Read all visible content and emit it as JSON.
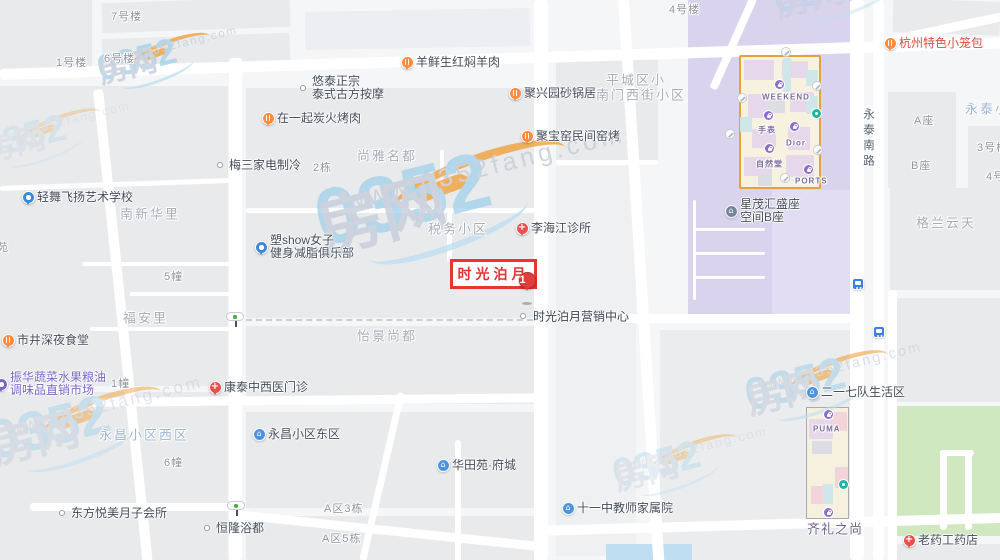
{
  "palette": {
    "accent_red": "#e23d3c",
    "restaurant_orange": "#ff8b3d",
    "medical_red": "#e8504d",
    "community_blue": "#4f94da",
    "education_blue": "#3d88dd",
    "market_purple": "#7a66c2",
    "building_slate": "#7286a0",
    "mall_purple": "#8a6fd0",
    "district_purple": "#d9d3ee",
    "park_green": "#cfe8c0",
    "water_blue": "#bfdef2"
  },
  "highlight": {
    "box": {
      "label": "时光泊月",
      "x": 450,
      "y": 259,
      "w": 87,
      "h": 30
    },
    "marker": {
      "number": "1",
      "x": 527,
      "y": 280
    },
    "caption": {
      "text": "时光泊月营销中心",
      "x": 533,
      "y": 316,
      "dot_x": 523,
      "dot_y": 316
    }
  },
  "road_label": {
    "text": "永泰南路",
    "x": 860,
    "y": 108
  },
  "watermark": {
    "brand_blue": "0352",
    "brand_gray": "房网",
    "url": "www.0352fang.com",
    "instances": [
      [
        95,
        58,
        0.95,
        0.8
      ],
      [
        310,
        196,
        2.1,
        0.8
      ],
      [
        -15,
        425,
        1.45,
        0.5
      ],
      [
        770,
        -14,
        1.15,
        0.45
      ],
      [
        742,
        382,
        1.2,
        0.6
      ],
      [
        610,
        462,
        1.05,
        0.38
      ],
      [
        -20,
        135,
        1.0,
        0.3
      ]
    ]
  },
  "pois": [
    {
      "x": 407,
      "y": 62,
      "icon": "restaurant-pin",
      "lines": [
        "羊鲜生红焖羊肉"
      ]
    },
    {
      "x": 515,
      "y": 93,
      "icon": "restaurant-pin",
      "lines": [
        "聚兴园砂锅居"
      ]
    },
    {
      "x": 527,
      "y": 136,
      "icon": "restaurant-pin",
      "lines": [
        "聚宝窑民间窑烤"
      ]
    },
    {
      "x": 268,
      "y": 118,
      "icon": "restaurant-pin",
      "lines": [
        "在一起炭火烤肉"
      ]
    },
    {
      "x": 890,
      "y": 43,
      "icon": "restaurant-pin",
      "lines": [
        "杭州特色小笼包"
      ],
      "tc": "#e04b43"
    },
    {
      "x": 8,
      "y": 340,
      "icon": "restaurant-pin",
      "lines": [
        "市井深夜食堂"
      ]
    },
    {
      "x": 303,
      "y": 88,
      "icon": "dot",
      "lines": [
        "悠泰正宗",
        "泰式古方按摩"
      ]
    },
    {
      "x": 220,
      "y": 165,
      "icon": "dot",
      "lines": [
        "梅三家电制冷"
      ]
    },
    {
      "x": 62,
      "y": 513,
      "icon": "dot",
      "lines": [
        "东方悦美月子会所"
      ]
    },
    {
      "x": 207,
      "y": 528,
      "icon": "dot",
      "lines": [
        "恒隆浴都"
      ]
    },
    {
      "x": 522,
      "y": 228,
      "icon": "medical-pin",
      "lines": [
        "李海江诊所"
      ]
    },
    {
      "x": 215,
      "y": 387,
      "icon": "medical-pin",
      "lines": [
        "康泰中西医门诊"
      ]
    },
    {
      "x": 909,
      "y": 540,
      "icon": "medical-pin",
      "lines": [
        "老药工药店"
      ]
    },
    {
      "x": 28,
      "y": 197,
      "icon": "education-pin",
      "lines": [
        "轻舞飞扬艺术学校"
      ]
    },
    {
      "x": 261,
      "y": 247,
      "icon": "education-pin",
      "lines": [
        "塑show女子",
        "健身减脂俱乐部"
      ]
    },
    {
      "x": 1,
      "y": 384,
      "icon": "market-pin",
      "lines": [
        "振华蔬菜水果粮油",
        "调味品直销市场"
      ],
      "tc": "#7a66c2"
    },
    {
      "x": 259,
      "y": 434,
      "icon": "community-icon",
      "lines": [
        "永昌小区东区"
      ]
    },
    {
      "x": 443,
      "y": 465,
      "icon": "community-icon",
      "lines": [
        "华田苑·府城"
      ]
    },
    {
      "x": 568,
      "y": 508,
      "icon": "community-icon",
      "lines": [
        "十一中教师家属院"
      ]
    },
    {
      "x": 812,
      "y": 392,
      "icon": "community-icon",
      "lines": [
        "二一七队生活区"
      ]
    },
    {
      "x": 731,
      "y": 211,
      "icon": "building-icon",
      "lines": [
        "星茂汇盛座",
        "空间B座"
      ]
    }
  ],
  "area_labels": [
    {
      "t": "尚雅名都",
      "x": 357,
      "y": 155
    },
    {
      "t": "税务小区",
      "x": 428,
      "y": 228
    },
    {
      "t": "平城区小",
      "x": 606,
      "y": 79
    },
    {
      "t": "南门西街小区",
      "x": 596,
      "y": 94
    },
    {
      "t": "南新华里",
      "x": 120,
      "y": 213
    },
    {
      "t": "福安里",
      "x": 123,
      "y": 317
    },
    {
      "t": "怡景尚都",
      "x": 357,
      "y": 335
    },
    {
      "t": "永昌小区西区",
      "x": 99,
      "y": 434,
      "c": "blue"
    },
    {
      "t": "格兰云天",
      "x": 916,
      "y": 222
    },
    {
      "t": "永泰小",
      "x": 965,
      "y": 108,
      "c": "blue"
    },
    {
      "t": "齐礼之尚",
      "x": 807,
      "y": 528,
      "c": "purple"
    }
  ],
  "building_labels": [
    {
      "t": "7号楼",
      "x": 111,
      "y": 16
    },
    {
      "t": "6号楼",
      "x": 104,
      "y": 58
    },
    {
      "t": "1号楼",
      "x": 56,
      "y": 62
    },
    {
      "t": "4号楼",
      "x": 669,
      "y": 9
    },
    {
      "t": "2栋",
      "x": 313,
      "y": 167
    },
    {
      "t": "5幢",
      "x": 164,
      "y": 276
    },
    {
      "t": "1幢",
      "x": 111,
      "y": 383
    },
    {
      "t": "6幢",
      "x": 164,
      "y": 462
    },
    {
      "t": "A区3栋",
      "x": 324,
      "y": 508
    },
    {
      "t": "A区5栋",
      "x": 322,
      "y": 538
    },
    {
      "t": "A座",
      "x": 914,
      "y": 120
    },
    {
      "t": "B座",
      "x": 911,
      "y": 165
    },
    {
      "t": "3号楼",
      "x": 977,
      "y": 147
    },
    {
      "t": "4号",
      "x": 986,
      "y": 176
    },
    {
      "t": "苑",
      "x": -3,
      "y": 247
    }
  ],
  "mall_weekend": {
    "outline": [
      739,
      55,
      82,
      134
    ],
    "rooms": [
      [
        744,
        60,
        30,
        20,
        "#e6d7ea"
      ],
      [
        782,
        61,
        26,
        17,
        "#e6d7ea"
      ],
      [
        748,
        94,
        20,
        24,
        "#e6d7ea"
      ],
      [
        790,
        92,
        24,
        20,
        "#e6d7ea"
      ],
      [
        752,
        129,
        24,
        19,
        "#e6d7ea"
      ],
      [
        788,
        127,
        22,
        23,
        "#e6d7ea"
      ],
      [
        744,
        157,
        28,
        19,
        "#e6d7ea"
      ],
      [
        786,
        155,
        28,
        22,
        "#e6d7ea"
      ],
      [
        783,
        58,
        8,
        34,
        "#cfe7e9"
      ],
      [
        806,
        96,
        12,
        18,
        "#cfe7e9"
      ],
      [
        740,
        117,
        12,
        15,
        "#cfe7e9"
      ],
      [
        806,
        70,
        12,
        16,
        "#cfe7e9"
      ],
      [
        768,
        100,
        17,
        13,
        "#dcdde2"
      ],
      [
        758,
        174,
        14,
        12,
        "#dcdde2"
      ]
    ],
    "stores": [
      {
        "t": "WEEKEND",
        "x": 762,
        "y": 97
      },
      {
        "t": "手表",
        "x": 758,
        "y": 130
      },
      {
        "t": "Dior",
        "x": 786,
        "y": 143
      },
      {
        "t": "自然堂",
        "x": 756,
        "y": 164
      },
      {
        "t": "PORTS",
        "x": 795,
        "y": 181
      }
    ],
    "bag_icons": [
      [
        779,
        84
      ],
      [
        768,
        115
      ],
      [
        794,
        126
      ],
      [
        769,
        148
      ],
      [
        808,
        169
      ]
    ],
    "facility_icons": [
      [
        786,
        52
      ],
      [
        817,
        86
      ],
      [
        742,
        98
      ],
      [
        730,
        134
      ],
      [
        785,
        178
      ],
      [
        818,
        150
      ]
    ],
    "green_icons": [
      [
        816,
        113
      ]
    ]
  },
  "mall_puma": {
    "outline": [
      806,
      407,
      43,
      112
    ],
    "rooms": [
      [
        809,
        419,
        24,
        20,
        "#e6d7ea"
      ],
      [
        812,
        441,
        20,
        13,
        "#dcdde2"
      ],
      [
        833,
        412,
        14,
        19,
        "#f3d4da"
      ],
      [
        835,
        467,
        13,
        21,
        "#f3d4da"
      ],
      [
        811,
        486,
        17,
        18,
        "#f3d4da"
      ],
      [
        823,
        484,
        10,
        20,
        "#cfe7e9"
      ]
    ],
    "stores": [
      {
        "t": "PUMA",
        "x": 813,
        "y": 429
      }
    ],
    "bag_icons": [
      [
        828,
        414
      ],
      [
        828,
        512
      ]
    ],
    "facility_icons": [],
    "green_icons": [
      [
        843,
        484
      ]
    ]
  },
  "transit": {
    "traffic_lights": [
      [
        235,
        316
      ],
      [
        236,
        505
      ]
    ],
    "bus_stops": [
      [
        858,
        284
      ],
      [
        879,
        332
      ]
    ]
  },
  "geometry": {
    "blocks": [
      [
        0,
        0,
        92,
        70,
        null,
        0,
        "city-block"
      ],
      [
        102,
        0,
        188,
        30,
        null,
        -2,
        "city-block"
      ],
      [
        102,
        36,
        188,
        34,
        null,
        -2,
        "city-block"
      ],
      [
        305,
        10,
        225,
        38,
        "#edeef1",
        -1,
        "city-block"
      ],
      [
        556,
        60,
        102,
        100,
        null,
        0,
        "city-block"
      ],
      [
        246,
        88,
        288,
        230,
        null,
        0,
        "city-block"
      ],
      [
        0,
        86,
        228,
        300,
        null,
        0,
        "city-block"
      ],
      [
        0,
        392,
        228,
        168,
        null,
        0,
        "city-block"
      ],
      [
        246,
        326,
        288,
        78,
        null,
        0,
        "city-block"
      ],
      [
        246,
        412,
        288,
        96,
        null,
        0,
        "city-block"
      ],
      [
        246,
        516,
        288,
        44,
        null,
        0,
        "city-block"
      ],
      [
        556,
        166,
        80,
        390,
        "#eff0f2",
        0,
        "city-block"
      ],
      [
        660,
        330,
        195,
        230,
        "#ebecee",
        0,
        "city-block"
      ],
      [
        688,
        0,
        168,
        318,
        "#d9d3ee",
        0,
        "mall-district-block"
      ],
      [
        772,
        190,
        80,
        125,
        "#e2ddf3",
        0,
        "mall-district-block"
      ],
      [
        893,
        0,
        107,
        34,
        null,
        2,
        "city-block"
      ],
      [
        888,
        92,
        68,
        96,
        null,
        0,
        "city-block"
      ],
      [
        968,
        126,
        32,
        68,
        null,
        0,
        "city-block"
      ],
      [
        890,
        188,
        110,
        102,
        null,
        0,
        "city-block"
      ],
      [
        890,
        298,
        110,
        104,
        null,
        0,
        "city-block"
      ],
      [
        897,
        406,
        103,
        130,
        "#cfe8c0",
        0,
        "park-block"
      ],
      [
        890,
        544,
        110,
        16,
        null,
        0,
        "city-block"
      ],
      [
        606,
        544,
        86,
        16,
        "#bfdef2",
        0,
        "water-block"
      ]
    ],
    "roads": [
      [
        0,
        69,
        1005,
        11,
        -1.8
      ],
      [
        534,
        0,
        14,
        560,
        0
      ],
      [
        229,
        58,
        13,
        502,
        0
      ],
      [
        93,
        90,
        10,
        475,
        -6
      ],
      [
        618,
        0,
        11,
        565,
        -3.6
      ],
      [
        850,
        0,
        14,
        560,
        0
      ],
      [
        873,
        0,
        11,
        560,
        0
      ],
      [
        92,
        398,
        448,
        9,
        -0.6
      ],
      [
        30,
        503,
        212,
        8,
        0
      ],
      [
        235,
        510,
        312,
        9,
        6
      ],
      [
        535,
        526,
        470,
        10,
        -1.6
      ],
      [
        620,
        314,
        240,
        9,
        0
      ],
      [
        880,
        38,
        128,
        9,
        -12
      ],
      [
        455,
        440,
        6,
        122,
        0
      ],
      [
        398,
        392,
        7,
        172,
        13
      ],
      [
        888,
        290,
        9,
        272,
        0
      ],
      [
        750,
        -4,
        8,
        100,
        24
      ],
      [
        246,
        208,
        290,
        5,
        0
      ],
      [
        447,
        212,
        5,
        50,
        0
      ],
      [
        0,
        186,
        232,
        5,
        -2
      ],
      [
        82,
        262,
        148,
        4,
        0
      ],
      [
        130,
        292,
        100,
        4,
        0
      ],
      [
        90,
        327,
        140,
        4,
        0
      ],
      [
        440,
        150,
        4,
        62,
        0
      ],
      [
        556,
        160,
        102,
        5,
        0
      ],
      [
        693,
        200,
        3,
        100,
        0
      ],
      [
        693,
        228,
        72,
        3,
        0
      ],
      [
        693,
        252,
        72,
        3,
        0
      ],
      [
        693,
        276,
        72,
        3,
        0
      ],
      [
        940,
        450,
        7,
        80,
        0
      ],
      [
        965,
        450,
        7,
        80,
        0
      ],
      [
        940,
        450,
        34,
        6,
        0
      ]
    ],
    "dotted_lines": [
      [
        246,
        319,
        287
      ]
    ]
  }
}
